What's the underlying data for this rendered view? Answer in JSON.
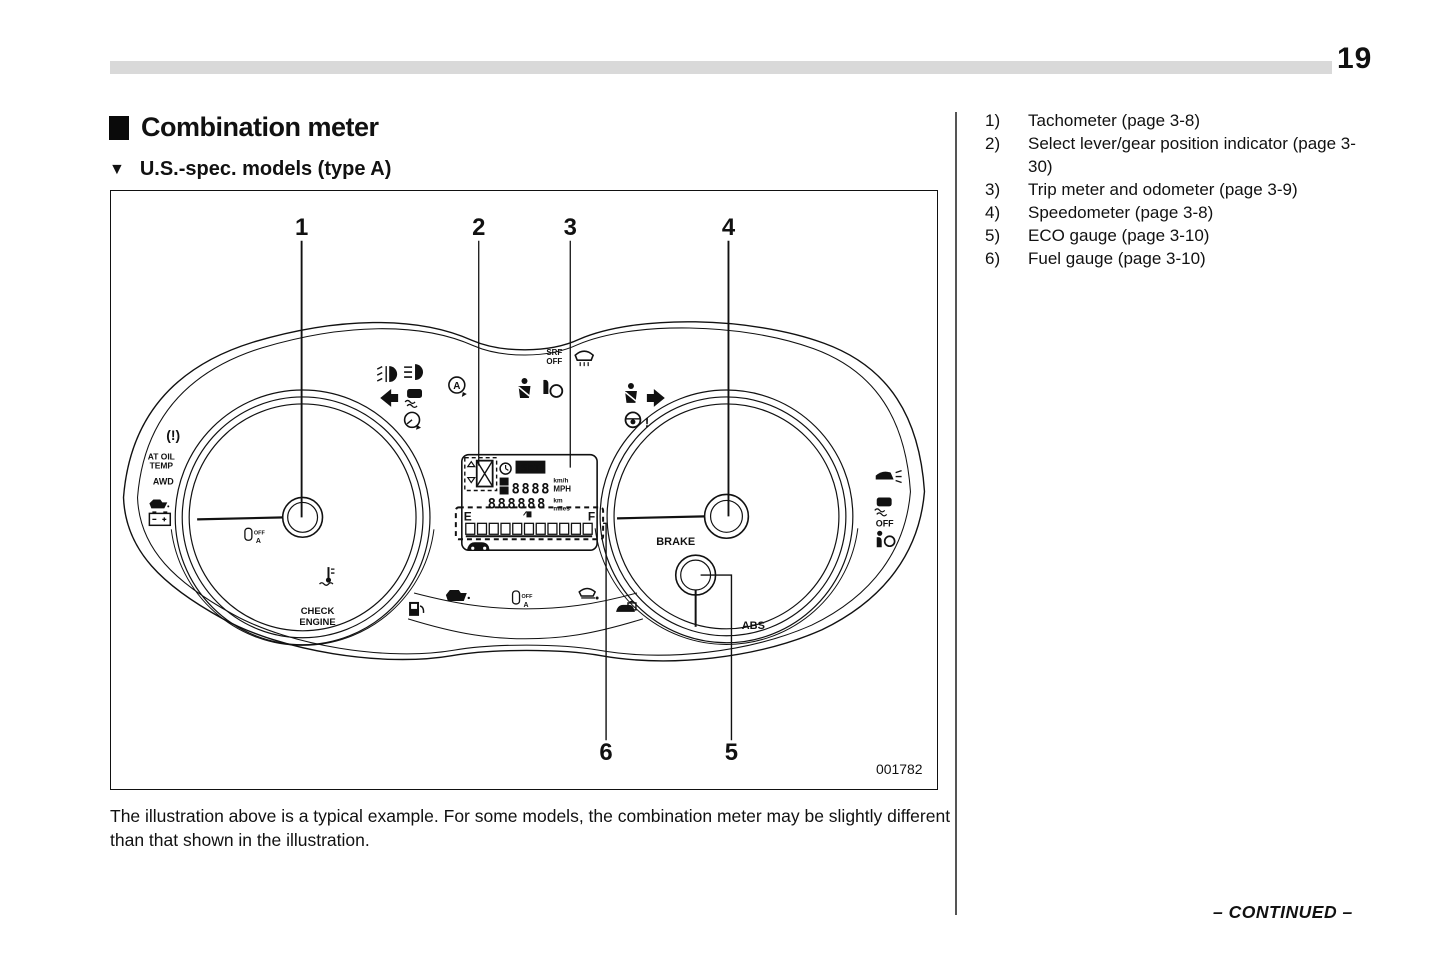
{
  "page": {
    "number": "19"
  },
  "section": {
    "title": "Combination meter",
    "subtitle": "U.S.-spec. models (type A)"
  },
  "figure": {
    "code": "001782",
    "callouts": [
      "1",
      "2",
      "3",
      "4",
      "5",
      "6"
    ],
    "labels": {
      "at_oil": "AT OIL",
      "temp": "TEMP",
      "awd": "AWD",
      "check": "CHECK",
      "engine": "ENGINE",
      "brake": "BRAKE",
      "abs": "ABS",
      "srf": "SRF",
      "srf_off": "OFF",
      "vdc_off": "OFF",
      "set": "SET",
      "a": "A",
      "b": "B",
      "e": "E",
      "f": "F",
      "kmh": "km/h",
      "mph": "MPH",
      "km": "km",
      "miles": "miles",
      "off_small": "OFF",
      "a_small": "A",
      "digits_row1": "8888",
      "digits_row2": "888888",
      "exclaim": "!"
    }
  },
  "caption": "The illustration above is a typical example. For some models, the combination meter may be slightly different than that shown in the illustration.",
  "legend": {
    "items": [
      {
        "num": "1)",
        "text": "Tachometer (page 3-8)"
      },
      {
        "num": "2)",
        "text": "Select lever/gear position indicator (page 3-30)"
      },
      {
        "num": "3)",
        "text": "Trip meter and odometer (page 3-9)"
      },
      {
        "num": "4)",
        "text": "Speedometer (page 3-8)"
      },
      {
        "num": "5)",
        "text": "ECO gauge (page 3-10)"
      },
      {
        "num": "6)",
        "text": "Fuel gauge (page 3-10)"
      }
    ]
  },
  "footer": {
    "continued": "– CONTINUED –"
  }
}
